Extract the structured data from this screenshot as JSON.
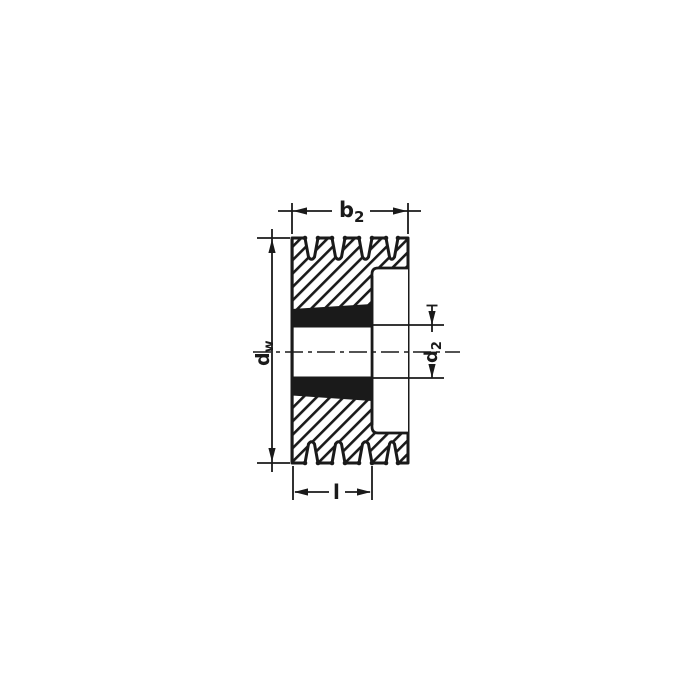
{
  "drawing": {
    "description": "V-belt pulley cross-section with taper bush, four grooves",
    "colors": {
      "ink": "#1a1a1a",
      "background": "#ffffff",
      "bush_fill": "#1a1a1a"
    }
  },
  "labels": {
    "b2": {
      "base": "b",
      "sub": "2"
    },
    "dw": {
      "base": "d",
      "sub": "w"
    },
    "d2": {
      "base": "d",
      "sub": "2"
    },
    "l": {
      "base": "l"
    }
  }
}
